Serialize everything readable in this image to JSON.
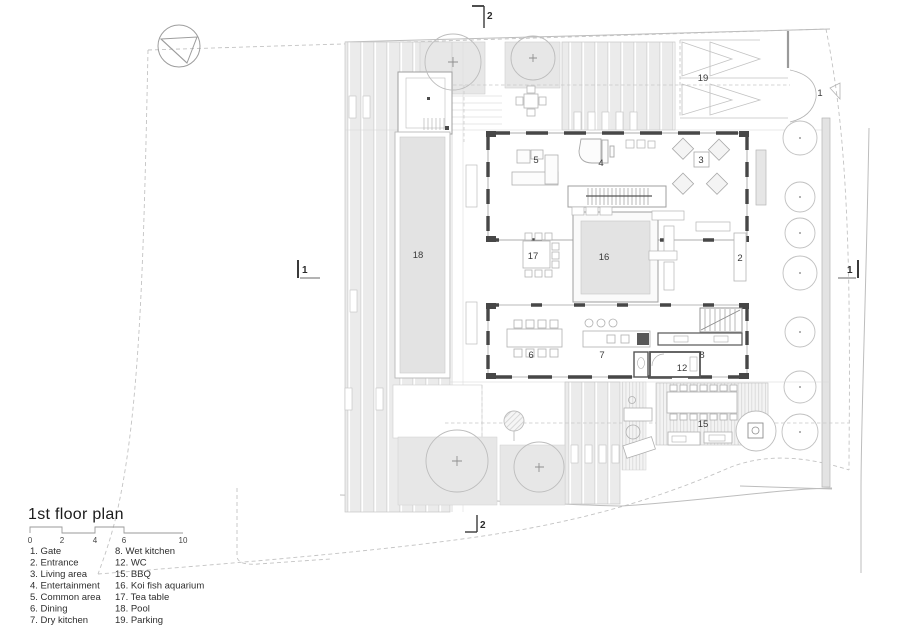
{
  "title": "1st floor plan",
  "scale_bar": {
    "ticks": [
      "0",
      "2",
      "4",
      "6",
      "10"
    ]
  },
  "legend": {
    "col1": [
      "1. Gate",
      "2. Entrance",
      "3. Living area",
      "4. Entertainment",
      "5. Common area",
      "6. Dining",
      "7. Dry kitchen"
    ],
    "col2": [
      "8. Wet kitchen",
      "12. WC",
      "15. BBQ",
      "16. Koi fish aquarium",
      "17. Tea table",
      "18. Pool",
      "19. Parking"
    ]
  },
  "plan_labels": {
    "gate": "1",
    "entrance_corridor": "2",
    "living_area": "3",
    "entertainment": "4",
    "common_area": "5",
    "dining": "6",
    "dry_kitchen": "7",
    "wet_kitchen": "8",
    "wc": "12",
    "bbq": "15",
    "koi_aquarium": "16",
    "tea_table": "17",
    "pool": "18",
    "parking": "19"
  },
  "section_markers": {
    "top": "2",
    "bottom": "2",
    "left": "1",
    "right": "1"
  },
  "colors": {
    "wall_dark": "#474747",
    "line_light": "#c7c7c7",
    "line_mid": "#a8a8a8",
    "fill_band": "#ececec",
    "fill_water": "#e3e3e3",
    "text": "#333333"
  }
}
